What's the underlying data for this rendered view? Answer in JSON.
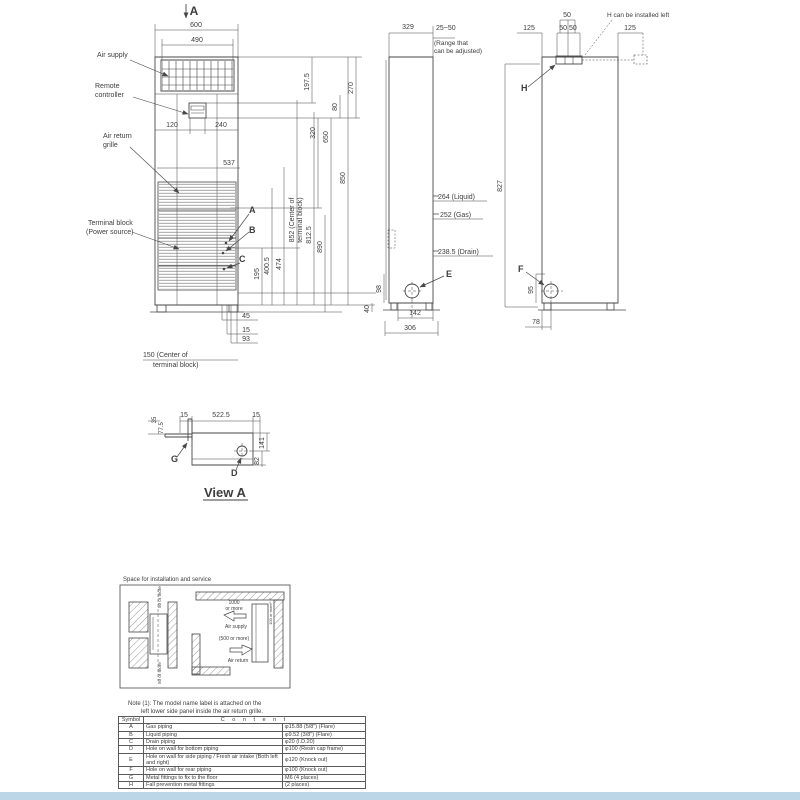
{
  "front": {
    "section_arrow": "A",
    "dim_600": "600",
    "dim_490": "490",
    "label_air_supply": "Air supply",
    "label_remote_1": "Remote",
    "label_remote_2": "controller",
    "label_return_1": "Air return",
    "label_return_2": "grille",
    "label_terminal_1": "Terminal block",
    "label_terminal_2": "(Power source)",
    "dim_120": "120",
    "dim_240": "240",
    "dim_537": "537",
    "dim_197_5": "197.5",
    "dim_80": "80",
    "dim_270": "270",
    "dim_320": "320",
    "dim_650": "650",
    "dim_850": "850",
    "dim_890": "890",
    "dim_812_5": "812.5",
    "dim_852_1": "852 (Center of",
    "dim_852_2": "terminal block)",
    "dim_474": "474",
    "dim_400_5": "400.5",
    "dim_195": "195",
    "point_a": "A",
    "point_b": "B",
    "point_c": "C",
    "dim_45": "45",
    "dim_15": "15",
    "dim_93": "93",
    "dim_150_1": "150 (Center of",
    "dim_150_2": "terminal block)",
    "dim_40": "40"
  },
  "side": {
    "dim_329": "329",
    "dim_range": "25~50",
    "range_note_1": "(Range that",
    "range_note_2": "can be adjusted)",
    "dim_liquid": "264 (Liquid)",
    "dim_gas": "252 (Gas)",
    "dim_drain": "238.5 (Drain)",
    "point_e": "E",
    "dim_98": "98",
    "dim_142": "142",
    "dim_306": "306"
  },
  "rear": {
    "dim_827": "827",
    "dim_125_left": "125",
    "dim_50_top": "50",
    "dim_50_50": "50 50",
    "dim_125_right": "125",
    "note_h": "H can be installed left",
    "point_h": "H",
    "point_f": "F",
    "dim_95": "95",
    "dim_78": "78"
  },
  "view_a": {
    "dim_15_left": "15",
    "dim_522_5": "522.5",
    "dim_15_right": "15",
    "dim_35": "35",
    "dim_77_5": "77.5",
    "point_g": "G",
    "point_d": "D",
    "dim_141": "141",
    "dim_82": "82",
    "title": "View A"
  },
  "install": {
    "title": "Space for installation and service",
    "left_top": "50 or more",
    "left_bottom": "50 or more",
    "supply_dim_1": "1000",
    "supply_dim_2": "or more",
    "supply_label": "Air supply",
    "return_dim": "(500 or more)",
    "return_label": "Air return",
    "right_gap": "100 or more"
  },
  "notes": {
    "line1": "Note (1): The model name label is attached on the",
    "line2": "left lower side panel inside the air return grille."
  },
  "table": {
    "header_symbol": "Symbol",
    "header_content": "C o n t e n t",
    "rows": [
      {
        "symbol": "A",
        "content": "Gas piping",
        "value": "φ15.88 (5/8\") (Flare)"
      },
      {
        "symbol": "B",
        "content": "Liquid piping",
        "value": "φ9.52 (3/8\") (Flare)"
      },
      {
        "symbol": "C",
        "content": "Drain piping",
        "value": "φ20 (I.D.20)"
      },
      {
        "symbol": "D",
        "content": "Hole on wall for bottom piping",
        "value": "φ100 (Resin cap frame)"
      },
      {
        "symbol": "E",
        "content": "Hole on wall for side piping / Fresh air intake (Both left and right)",
        "value": "φ120 (Knock out)"
      },
      {
        "symbol": "F",
        "content": "Hole on wall for rear piping",
        "value": "φ100 (Knock out)"
      },
      {
        "symbol": "G",
        "content": "Metal fittings to fix to the floor",
        "value": "M6 (4 places)"
      },
      {
        "symbol": "H",
        "content": "Fall prevention metal fittings",
        "value": "(2 places)"
      }
    ]
  },
  "colors": {
    "line": "#474747",
    "accent_bar": "#bcd6e8"
  }
}
